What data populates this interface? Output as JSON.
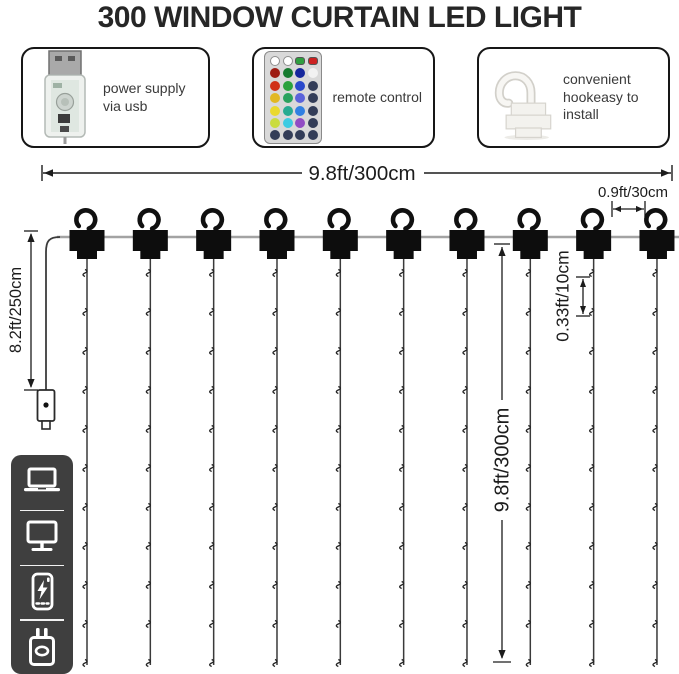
{
  "title": "300 WINDOW CURTAIN LED LIGHT",
  "features": [
    {
      "name": "usb-power",
      "label": "power supply via usb"
    },
    {
      "name": "remote-control",
      "label": "remote control",
      "remote_button_rows": [
        [
          "#ffffff",
          "#ffffff",
          "#2f9e3f",
          "#cc2222"
        ],
        [
          "#9e1b12",
          "#157a2e",
          "#16279c",
          "#f2f2f2"
        ],
        [
          "#d03018",
          "#2aa23c",
          "#2a49cc",
          "#333d58"
        ],
        [
          "#e2b822",
          "#2aa25e",
          "#5b63da",
          "#333d58"
        ],
        [
          "#ead92e",
          "#27ab91",
          "#3180e2",
          "#333d58"
        ],
        [
          "#cadc3e",
          "#3ecbe2",
          "#914cc4",
          "#333d58"
        ],
        [
          "#333d58",
          "#333d58",
          "#333d58",
          "#333d58"
        ]
      ]
    },
    {
      "name": "hanging-hook",
      "label": "convenient hookeasy to install"
    }
  ],
  "dimensions": {
    "total_width": "9.8ft/300cm",
    "end_hook_spacing": "0.9ft/30cm",
    "side_height": "8.2ft/250cm",
    "strand_drop": "9.8ft/300cm",
    "led_spacing": "0.33ft/10cm"
  },
  "diagram": {
    "hook_count": 10,
    "leds_per_strand": 11
  },
  "device_icons": [
    "laptop",
    "desktop-monitor",
    "power-bank",
    "usb-wall-charger"
  ],
  "colors": {
    "title_text": "#262626",
    "dimension_ink": "#1c1c1c",
    "wire_gray": "#a3a3a3",
    "hardware_black": "#0d0d0d",
    "strip_background": "#3f3f3f"
  }
}
